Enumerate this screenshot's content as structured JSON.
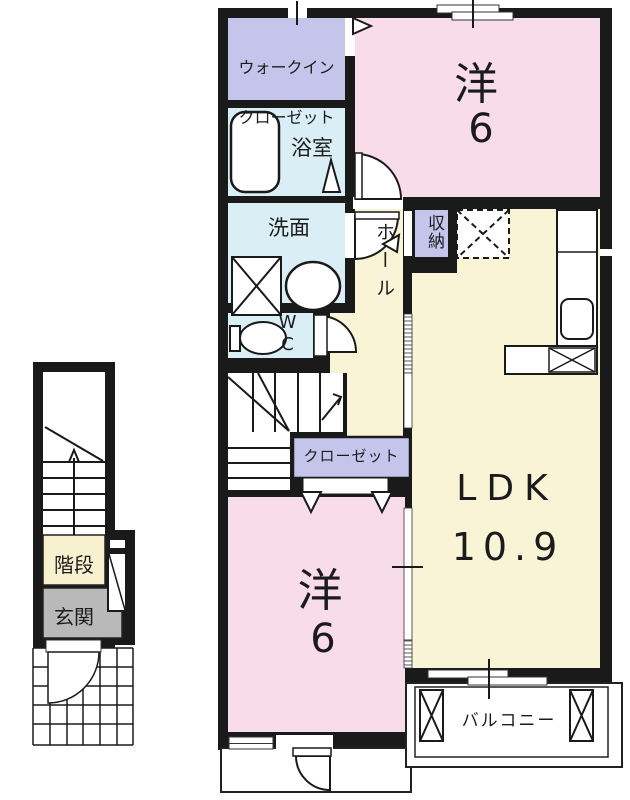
{
  "title": "2F apartment floor plan",
  "rooms": {
    "walk_in_closet": {
      "line1": "ウォークイン",
      "line2": "クローゼット"
    },
    "bathroom": "浴室",
    "washroom": "洗面",
    "toilet": "WC",
    "hall": "ホール",
    "storage": "収納",
    "bedroom_upper": {
      "name": "洋",
      "size": "6"
    },
    "ldk": {
      "name": "LDK",
      "size": "10.9"
    },
    "closet": "クローゼット",
    "bedroom_lower": {
      "name": "洋",
      "size": "6"
    },
    "balcony": "バルコニー"
  },
  "first_floor": {
    "stairs": "階段",
    "entrance": "玄関"
  },
  "colors": {
    "wall": "#1a1a1a",
    "room_pink": "#f8dce9",
    "room_yellow": "#faf4d6",
    "room_blue": "#daeef5",
    "room_purple": "#c5c5ec",
    "entrance_gray": "#b9b9b9",
    "stair_yellow": "#f7f1cf",
    "floor_white": "#ffffff"
  }
}
